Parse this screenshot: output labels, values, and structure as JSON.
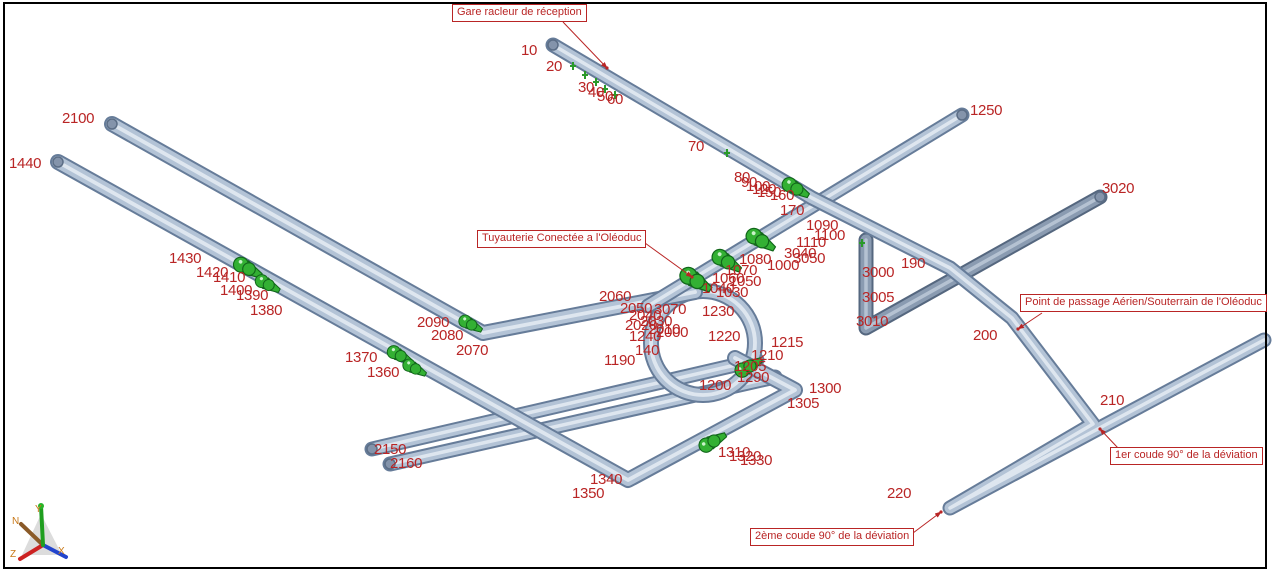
{
  "view": {
    "description": "3D isometric piping model view",
    "colors": {
      "node_label_red": "#b92525",
      "callout_red": "#b92525",
      "pipe_body": "#b3c3d6",
      "pipe_edge": "#667c99",
      "pipe_sheen": "#e2eaf2",
      "pipe_dark_body": "#8a9bb1",
      "pipe_dark_edge": "#55677f",
      "valve_green": "#33b033",
      "valve_green_dark": "#11661a",
      "axis_label_orange": "#c87818",
      "border_black": "#000000"
    }
  },
  "callouts": [
    {
      "id": "gare",
      "text": "Gare racleur de réception"
    },
    {
      "id": "tuyauterie",
      "text": "Tuyauterie Conectée a l'Oléoduc"
    },
    {
      "id": "passage",
      "text": "Point de passage Aérien/Souterrain de l'Oléoduc"
    },
    {
      "id": "coude1",
      "text": "1er coude 90° de la déviation"
    },
    {
      "id": "coude2",
      "text": "2ème coude 90° de la déviation"
    }
  ],
  "axis": {
    "labels": [
      "N",
      "Y",
      "Z",
      "X"
    ]
  },
  "nodes": [
    {
      "t": "10",
      "x": 521,
      "y": 43
    },
    {
      "t": "20",
      "x": 546,
      "y": 59
    },
    {
      "t": "30",
      "x": 578,
      "y": 80
    },
    {
      "t": "40",
      "x": 588,
      "y": 85
    },
    {
      "t": "50",
      "x": 597,
      "y": 89
    },
    {
      "t": "60",
      "x": 607,
      "y": 92
    },
    {
      "t": "70",
      "x": 688,
      "y": 139
    },
    {
      "t": "80",
      "x": 734,
      "y": 170
    },
    {
      "t": "90",
      "x": 741,
      "y": 175
    },
    {
      "t": "100",
      "x": 746,
      "y": 179
    },
    {
      "t": "120",
      "x": 752,
      "y": 182
    },
    {
      "t": "150",
      "x": 757,
      "y": 185
    },
    {
      "t": "160",
      "x": 770,
      "y": 188
    },
    {
      "t": "170",
      "x": 780,
      "y": 203
    },
    {
      "t": "1090",
      "x": 806,
      "y": 218
    },
    {
      "t": "1100",
      "x": 814,
      "y": 228
    },
    {
      "t": "1110",
      "x": 796,
      "y": 235
    },
    {
      "t": "3040",
      "x": 784,
      "y": 246
    },
    {
      "t": "3050",
      "x": 793,
      "y": 251
    },
    {
      "t": "1000",
      "x": 767,
      "y": 258
    },
    {
      "t": "1080",
      "x": 739,
      "y": 252
    },
    {
      "t": "1070",
      "x": 725,
      "y": 263
    },
    {
      "t": "1060",
      "x": 712,
      "y": 271
    },
    {
      "t": "1050",
      "x": 729,
      "y": 274
    },
    {
      "t": "1040",
      "x": 702,
      "y": 281
    },
    {
      "t": "1030",
      "x": 716,
      "y": 285
    },
    {
      "t": "1250",
      "x": 970,
      "y": 103
    },
    {
      "t": "3020",
      "x": 1102,
      "y": 181
    },
    {
      "t": "190",
      "x": 901,
      "y": 256
    },
    {
      "t": "3000",
      "x": 862,
      "y": 265
    },
    {
      "t": "3005",
      "x": 862,
      "y": 290
    },
    {
      "t": "3010",
      "x": 856,
      "y": 314
    },
    {
      "t": "200",
      "x": 973,
      "y": 328
    },
    {
      "t": "210",
      "x": 1100,
      "y": 393
    },
    {
      "t": "220",
      "x": 887,
      "y": 486
    },
    {
      "t": "2100",
      "x": 62,
      "y": 111
    },
    {
      "t": "1440",
      "x": 9,
      "y": 156
    },
    {
      "t": "1430",
      "x": 169,
      "y": 251
    },
    {
      "t": "1420",
      "x": 196,
      "y": 265
    },
    {
      "t": "1410",
      "x": 213,
      "y": 270
    },
    {
      "t": "1400",
      "x": 220,
      "y": 283
    },
    {
      "t": "1390",
      "x": 236,
      "y": 288
    },
    {
      "t": "1380",
      "x": 250,
      "y": 303
    },
    {
      "t": "1370",
      "x": 345,
      "y": 350
    },
    {
      "t": "1360",
      "x": 367,
      "y": 365
    },
    {
      "t": "2090",
      "x": 417,
      "y": 315
    },
    {
      "t": "2080",
      "x": 431,
      "y": 328
    },
    {
      "t": "2070",
      "x": 456,
      "y": 343
    },
    {
      "t": "2060",
      "x": 599,
      "y": 289
    },
    {
      "t": "2050",
      "x": 620,
      "y": 301
    },
    {
      "t": "2040",
      "x": 629,
      "y": 308
    },
    {
      "t": "2030",
      "x": 640,
      "y": 314
    },
    {
      "t": "2020",
      "x": 625,
      "y": 318
    },
    {
      "t": "2010",
      "x": 648,
      "y": 322
    },
    {
      "t": "3070",
      "x": 654,
      "y": 302
    },
    {
      "t": "1230",
      "x": 702,
      "y": 304
    },
    {
      "t": "2000",
      "x": 656,
      "y": 325
    },
    {
      "t": "1240",
      "x": 629,
      "y": 329
    },
    {
      "t": "140",
      "x": 635,
      "y": 343
    },
    {
      "t": "1220",
      "x": 708,
      "y": 329
    },
    {
      "t": "1215",
      "x": 771,
      "y": 335
    },
    {
      "t": "1210",
      "x": 751,
      "y": 348
    },
    {
      "t": "1205",
      "x": 734,
      "y": 359
    },
    {
      "t": "1290",
      "x": 737,
      "y": 370
    },
    {
      "t": "1200",
      "x": 699,
      "y": 378
    },
    {
      "t": "1190",
      "x": 604,
      "y": 353
    },
    {
      "t": "1300",
      "x": 809,
      "y": 381
    },
    {
      "t": "1305",
      "x": 787,
      "y": 396
    },
    {
      "t": "1310",
      "x": 718,
      "y": 445
    },
    {
      "t": "1320",
      "x": 729,
      "y": 449
    },
    {
      "t": "1330",
      "x": 740,
      "y": 453
    },
    {
      "t": "1340",
      "x": 590,
      "y": 472
    },
    {
      "t": "1350",
      "x": 572,
      "y": 486
    },
    {
      "t": "2150",
      "x": 374,
      "y": 442
    },
    {
      "t": "2160",
      "x": 390,
      "y": 456
    }
  ]
}
